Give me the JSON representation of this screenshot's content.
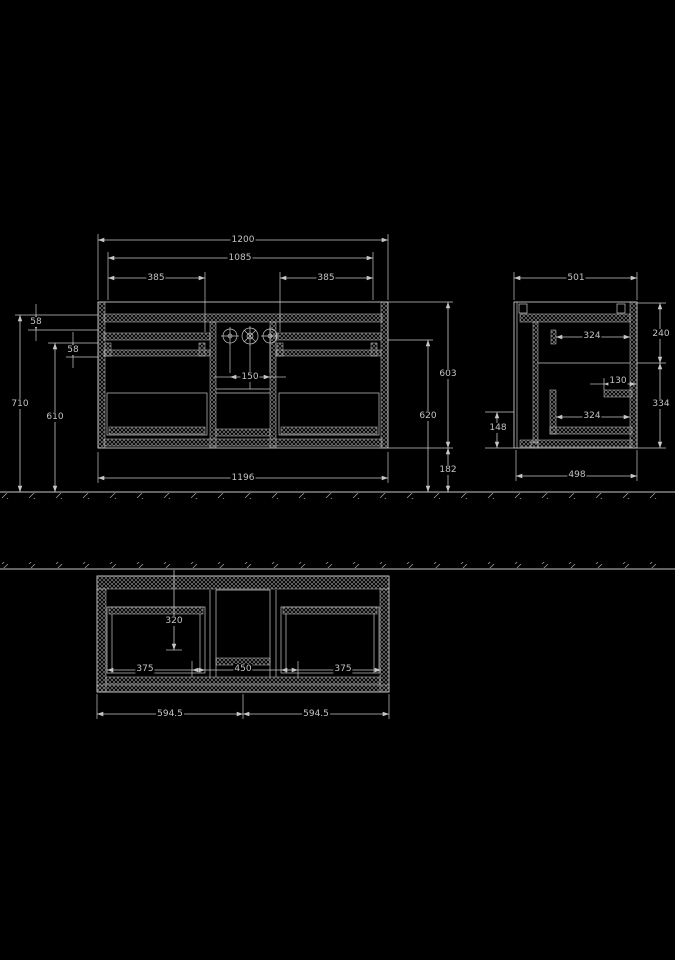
{
  "colors": {
    "background": "#000000",
    "line": "#c6c6c6",
    "text": "#c4c4c4"
  },
  "front": {
    "w1200": "1200",
    "w1085": "1085",
    "w385l": "385",
    "w385r": "385",
    "h58a": "58",
    "h58b": "58",
    "h710": "710",
    "h610": "610",
    "h603": "603",
    "h620": "620",
    "h182": "182",
    "s150": "150",
    "w1196": "1196"
  },
  "side": {
    "w501": "501",
    "d324u": "324",
    "h240": "240",
    "d130": "130",
    "d324l": "324",
    "h334": "334",
    "h148": "148",
    "w498": "498"
  },
  "plan": {
    "d320": "320",
    "w375l": "375",
    "w450": "450",
    "w375r": "375",
    "w5945l": "594.5",
    "w5945r": "594.5"
  }
}
